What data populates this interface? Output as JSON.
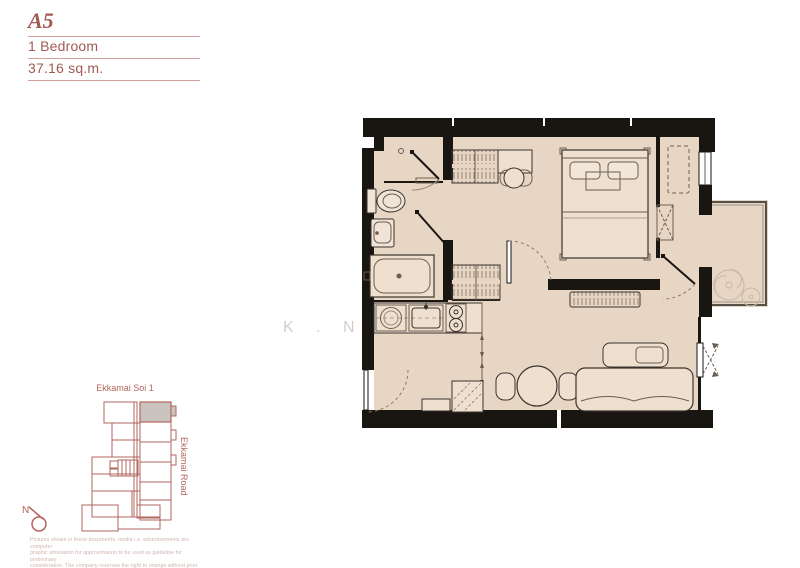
{
  "header": {
    "unit_code": "A5",
    "unit_type": "1 Bedroom",
    "unit_area": "37.16 sq.m."
  },
  "watermark": "K . N O",
  "site_plan": {
    "street_top_label": "Ekkamai Soi 1",
    "street_right_label": "Ekkamai Road",
    "north_label": "N"
  },
  "disclaimer": {
    "line1": "Pictures shown in these documents, media i.e. advertisements are computer",
    "line2": "graphic simulation for approximation to be used as guideline for preliminary",
    "line3": "consideration. The company reserves the right to change without prior notice."
  },
  "colors": {
    "brand_red": "#a05a52",
    "floor_fill": "#e8d6c5",
    "wall_black": "#191511",
    "highlight_unit_gray": "#cac4c0"
  }
}
